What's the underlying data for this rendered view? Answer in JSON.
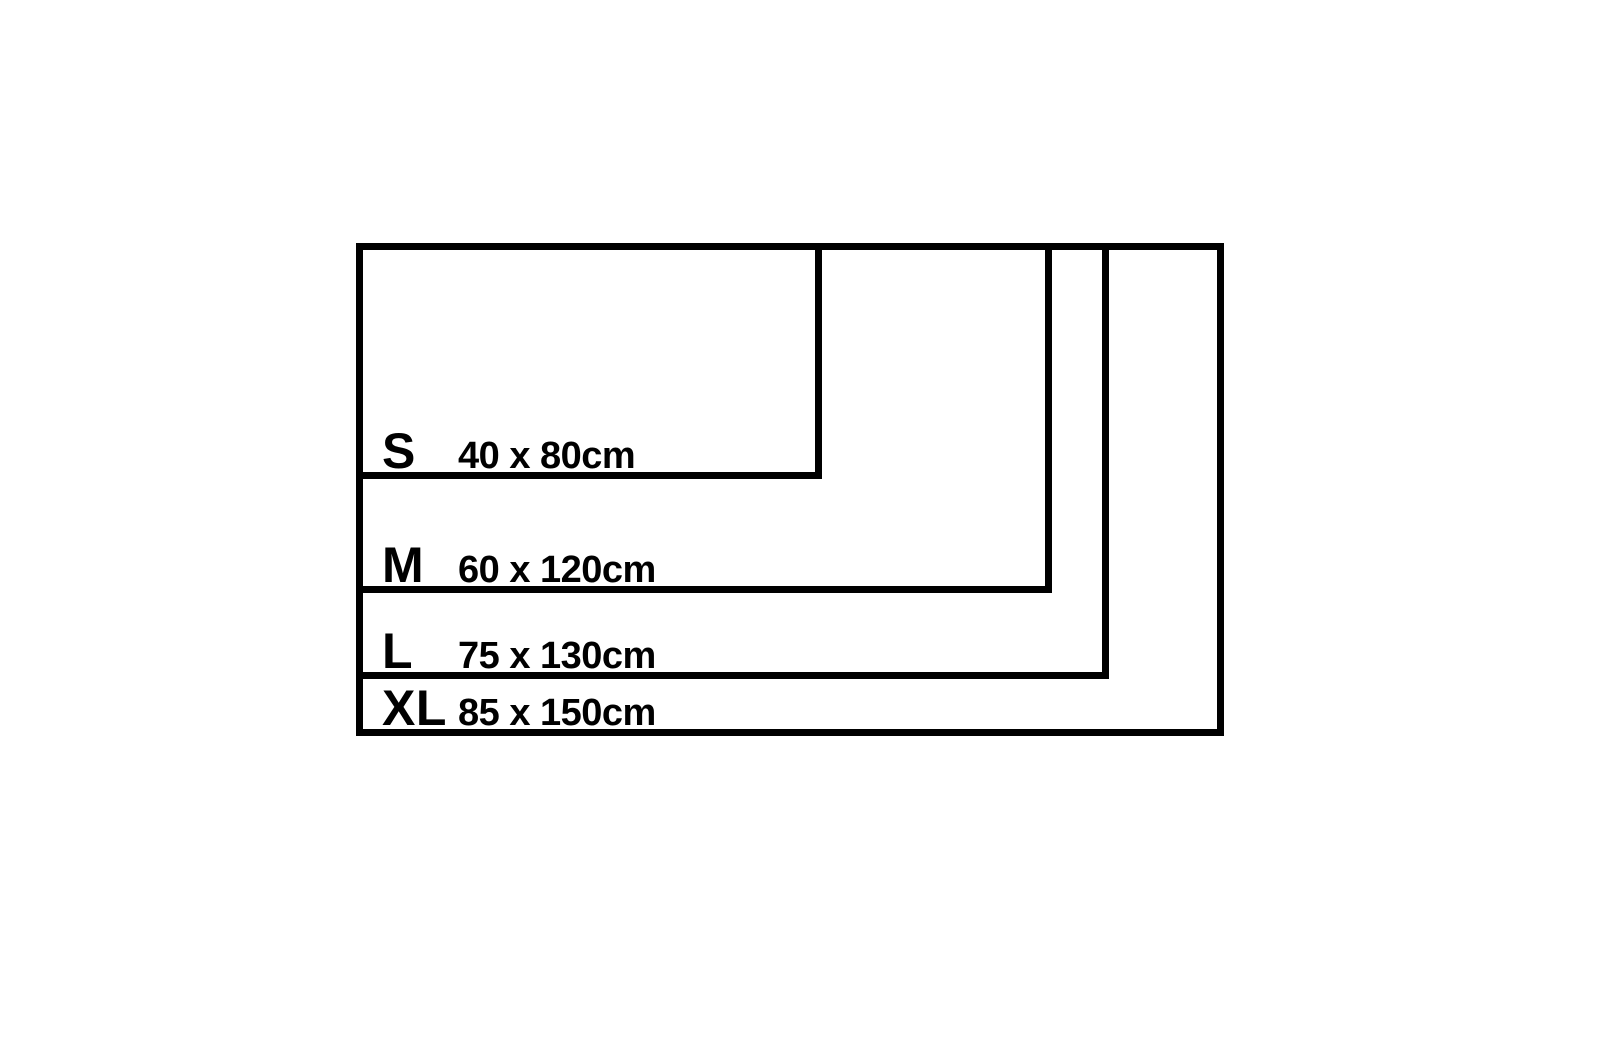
{
  "page": {
    "background_color": "#ffffff",
    "line_color": "#000000"
  },
  "chart_data": {
    "type": "diagram",
    "title": "",
    "unit": "cm",
    "layout": "nested rectangles sharing top-left corner, drawn to scale",
    "sizes": [
      {
        "label": "S",
        "size_text": "40 x 80cm",
        "height_cm": 40,
        "width_cm": 80
      },
      {
        "label": "M",
        "size_text": "60 x 120cm",
        "height_cm": 60,
        "width_cm": 120
      },
      {
        "label": "L",
        "size_text": "75 x 130cm",
        "height_cm": 75,
        "width_cm": 130
      },
      {
        "label": "XL",
        "size_text": "85 x 150cm",
        "height_cm": 85,
        "width_cm": 150
      }
    ]
  }
}
